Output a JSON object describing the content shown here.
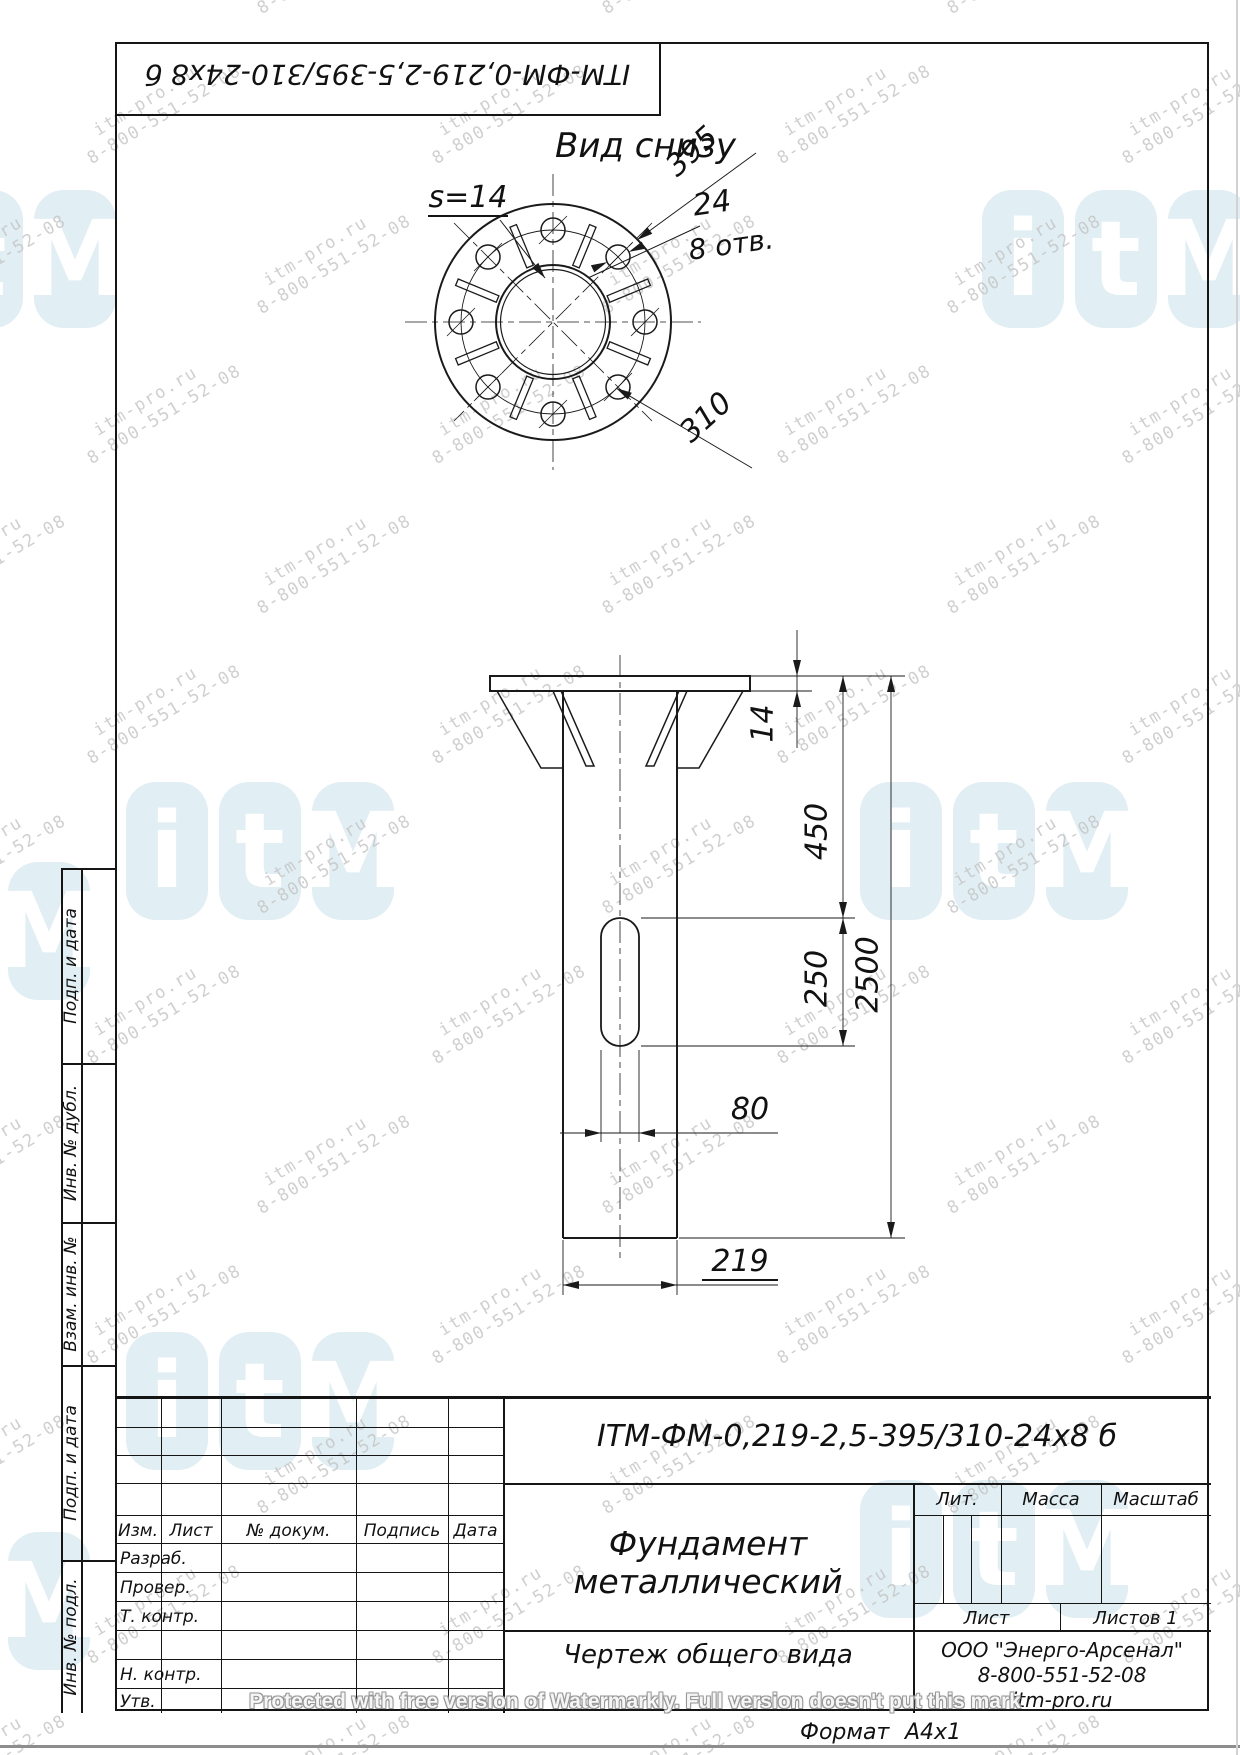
{
  "watermark": {
    "site": "itm-pro.ru",
    "phone": "8-800-551-52-08",
    "logo_letters": [
      "i",
      "t",
      "M"
    ],
    "protect_text": "Protected with free version of Watermarkly. Full version doesn't put this mark"
  },
  "drawing": {
    "stamp_rotated": "ITM-ФМ-0,219-2,5-395/310-24x8 б",
    "bottom_view": {
      "title": "Вид снизу",
      "thickness": "s=14",
      "flange_dia": "395",
      "hole_dia": "24",
      "holes_note": "8 отв.",
      "bolt_circle": "310"
    },
    "front_view": {
      "plate_thickness": "14",
      "rib_height": "450",
      "slot_length": "250",
      "total_length": "2500",
      "slot_width": "80",
      "pipe_dia": "219"
    }
  },
  "side_column": {
    "items": [
      "Подп. и дата",
      "Инв. № дубл.",
      "Взам. инв. №",
      "Подп. и дата",
      "Инв. № подл."
    ]
  },
  "title_block": {
    "designation": "ITM-ФМ-0,219-2,5-395/310-24x8 б",
    "name_line1": "Фундамент",
    "name_line2": "металлический",
    "doc_type": "Чертеж общего вида",
    "company": "ООО \"Энерго-Арсенал\"",
    "phone": "8-800-551-52-08",
    "site": "itm-pro.ru",
    "col_izm": "Изм.",
    "col_list": "Лист",
    "col_doc": "№ докум.",
    "col_sign": "Подпись",
    "col_date": "Дата",
    "row_razrab": "Разраб.",
    "row_prover": "Провер.",
    "row_tkontr": "Т. контр.",
    "row_nkontr": "Н. контр.",
    "row_utv": "Утв.",
    "lit": "Лит.",
    "massa": "Масса",
    "masshtab": "Масштаб",
    "sheet_label": "Лист",
    "sheets_label": "Листов 1"
  },
  "footer": {
    "format_label": "Формат",
    "format_value": "A4x1"
  }
}
